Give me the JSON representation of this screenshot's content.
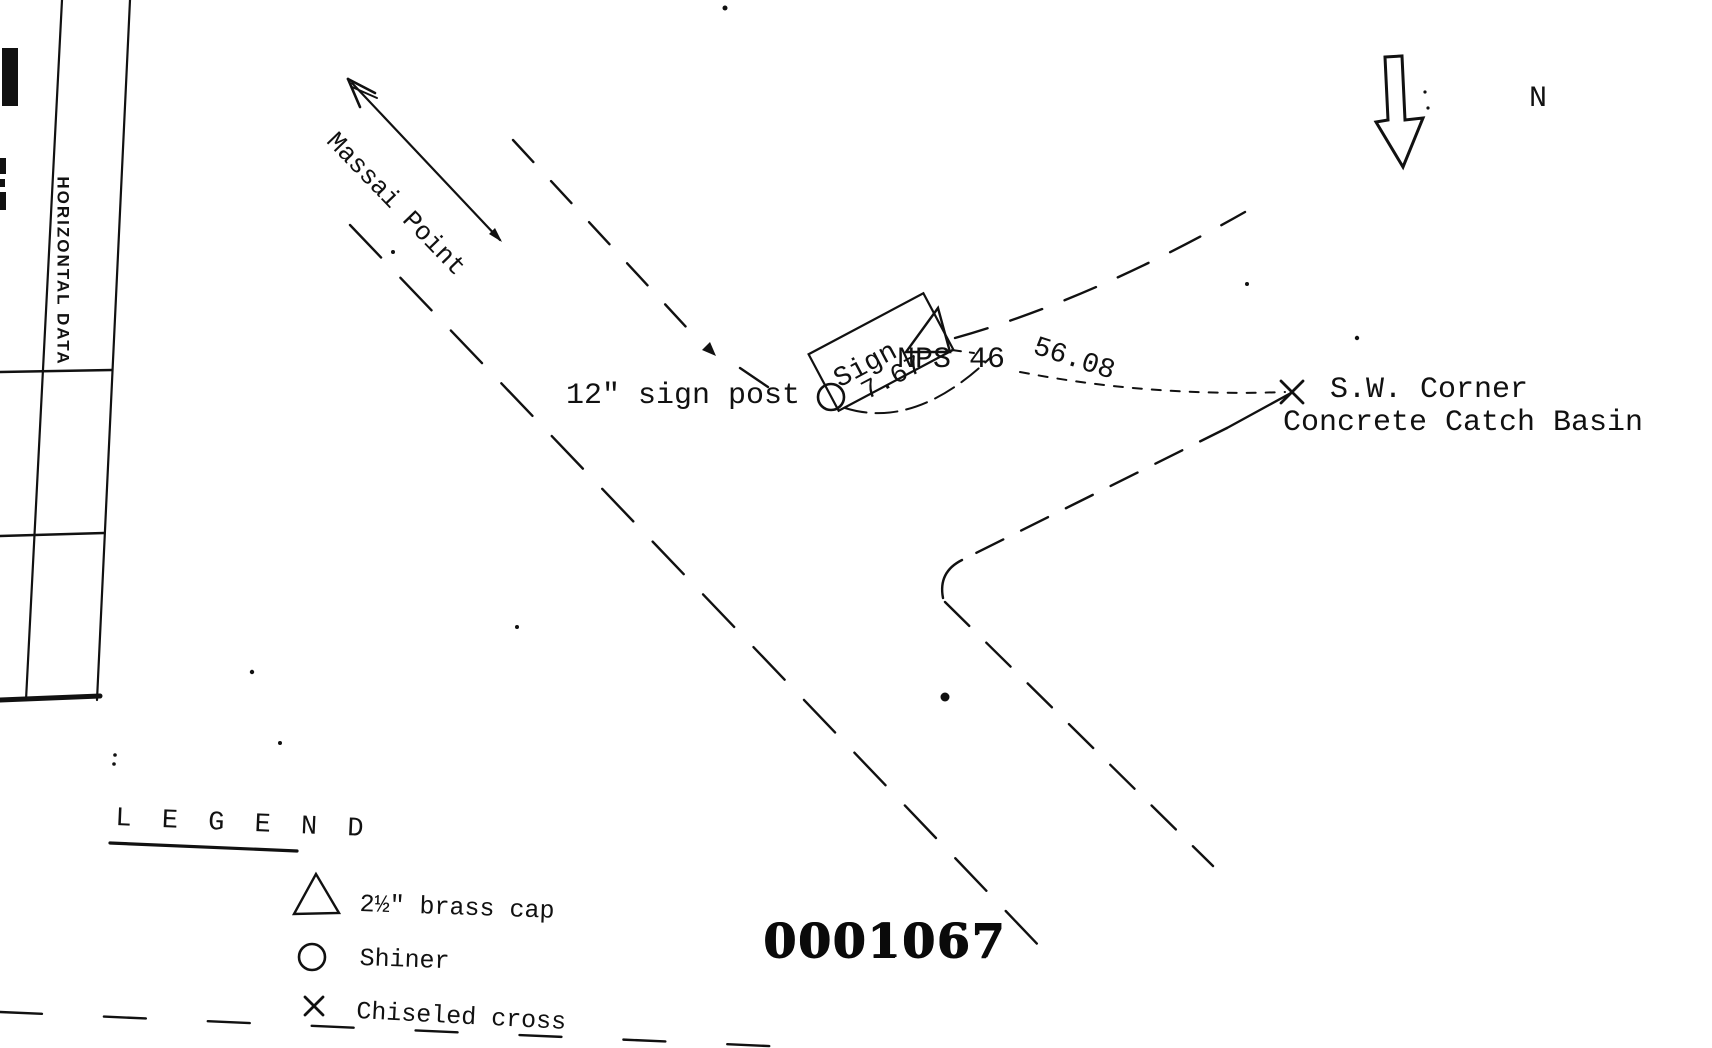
{
  "document": {
    "background": "#ffffff",
    "ink": "#111111"
  },
  "form_panel": {
    "column_header": "HORIZONTAL DATA"
  },
  "north_arrow": {
    "label": "N"
  },
  "road": {
    "destination_label": "Massai Point"
  },
  "annotations": {
    "sign_post_label": "12\" sign post",
    "sign_label": "Sign",
    "tie_distance_sign": "7.67",
    "station_label": "NPS 46",
    "tie_distance_basin": "56.08",
    "basin_corner_line1": "S.W. Corner",
    "basin_corner_line2": "Concrete Catch Basin"
  },
  "legend": {
    "title": "L E G E N D",
    "items": [
      {
        "symbol": "brass-cap-triangle",
        "label": "2½\" brass cap"
      },
      {
        "symbol": "shiner-circle",
        "label": "Shiner"
      },
      {
        "symbol": "chiseled-cross",
        "label": "Chiseled cross"
      }
    ]
  },
  "stamp": {
    "number": "0001067"
  }
}
